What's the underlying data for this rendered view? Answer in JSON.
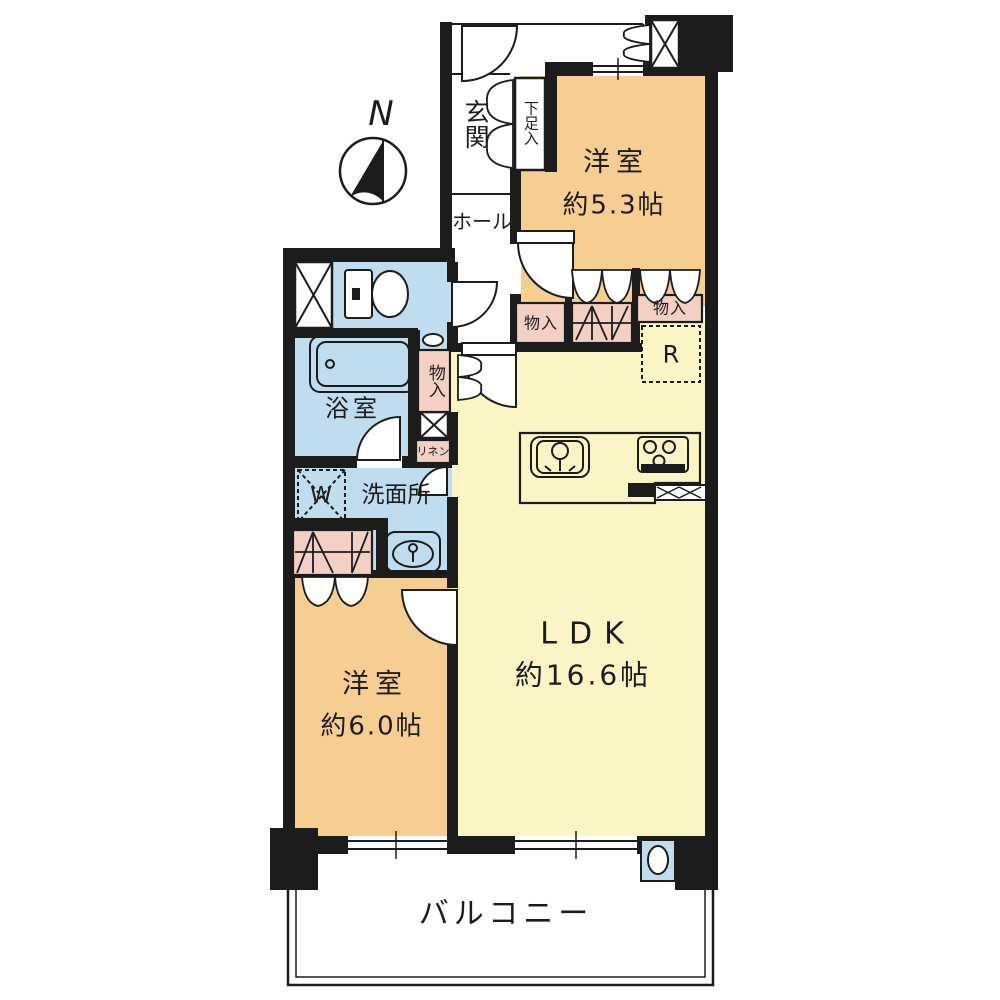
{
  "colors": {
    "wall": "#1c1c1c",
    "line": "#1c1c1c",
    "room_orange": "#F7CE92",
    "room_yellow": "#FBF5C6",
    "room_blue": "#C0DDEF",
    "closet_pink": "#F4CFC3",
    "white": "#ffffff"
  },
  "compass": {
    "north_label": "N"
  },
  "rooms": {
    "entrance": {
      "label": "玄関"
    },
    "shoe_storage": {
      "label": "下足入"
    },
    "hall": {
      "label": "ホール"
    },
    "bedroom1": {
      "label": "洋室",
      "size": "約5.3帖"
    },
    "bedroom2": {
      "label": "洋室",
      "size": "約6.0帖"
    },
    "ldk": {
      "label": "LDK",
      "size": "約16.6帖"
    },
    "bathroom": {
      "label": "浴室"
    },
    "washroom": {
      "label": "洗面所"
    },
    "balcony": {
      "label": "バルコニー"
    }
  },
  "storages": {
    "closet_a": {
      "label": "物入"
    },
    "closet_b": {
      "label": "物入"
    },
    "closet_hall": {
      "label": "物入"
    },
    "linen": {
      "label": "リネン"
    }
  },
  "appliances": {
    "washer": {
      "label": "W"
    },
    "refrigerator": {
      "label": "R"
    }
  },
  "icons": [
    "compass-north",
    "toilet",
    "bathtub",
    "washbasin",
    "hand-basin",
    "kitchen-sink",
    "gas-stove",
    "washer-box",
    "refrigerator-box",
    "slop-sink",
    "meter-box",
    "shaft-box"
  ]
}
